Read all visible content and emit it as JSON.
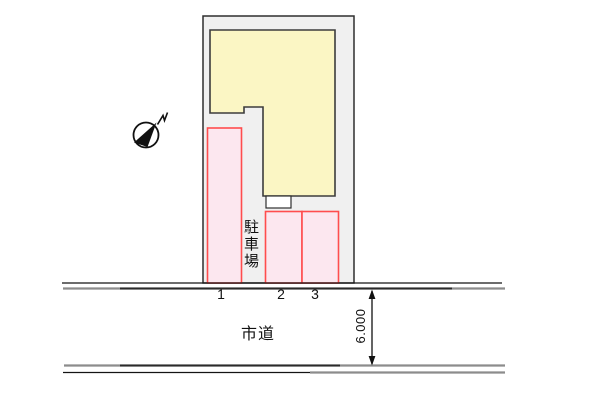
{
  "page": {
    "type": "site-plan-drawing",
    "background": "#ffffff"
  },
  "site_plan": {
    "labels": {
      "parking_area": "駐車場",
      "road": "市道",
      "road_width_dimension": "6.000"
    },
    "parking_spaces": [
      {
        "label": "1"
      },
      {
        "label": "2"
      },
      {
        "label": "3"
      }
    ],
    "icons": {
      "north_arrow": "north-compass-arrow"
    },
    "colors": {
      "plot_fill": "#f0f0f0",
      "plot_outline": "#2e2e2e",
      "building_fill": "#fbf6c4",
      "building_outline": "#3c3c3c",
      "parking_fill": "#fce7ef",
      "parking_outline": "#ff4d4d",
      "road_edge_gray": "#8c8c8c",
      "road_edge_black": "#141414"
    }
  }
}
